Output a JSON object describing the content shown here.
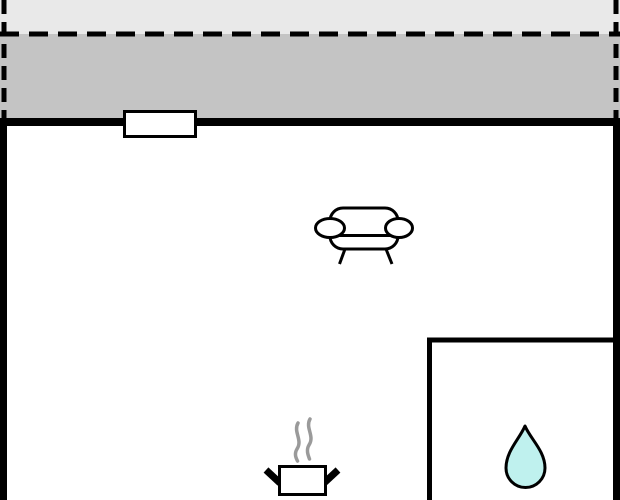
{
  "canvas": {
    "width": 620,
    "height": 500
  },
  "floorplan": {
    "regions": [
      {
        "name": "exterior-margin",
        "fill": "#e9e9e9"
      },
      {
        "name": "balcony",
        "fill": "#c4c4c4"
      },
      {
        "name": "living-room",
        "fill": "#ffffff"
      },
      {
        "name": "bathroom",
        "fill": "#ffffff"
      }
    ],
    "icons": [
      {
        "name": "sofa-icon"
      },
      {
        "name": "cooking-pot-icon"
      },
      {
        "name": "steam-icon"
      },
      {
        "name": "water-drop-icon"
      }
    ]
  },
  "colors": {
    "wall": "#000000",
    "exterior_margin": "#e9e9e9",
    "balcony": "#c4c4c4",
    "room_fill": "#ffffff",
    "icon_stroke": "#000000",
    "icon_fill": "#ffffff",
    "steam": "#9a9a9a",
    "water_fill": "#bff1ee"
  }
}
